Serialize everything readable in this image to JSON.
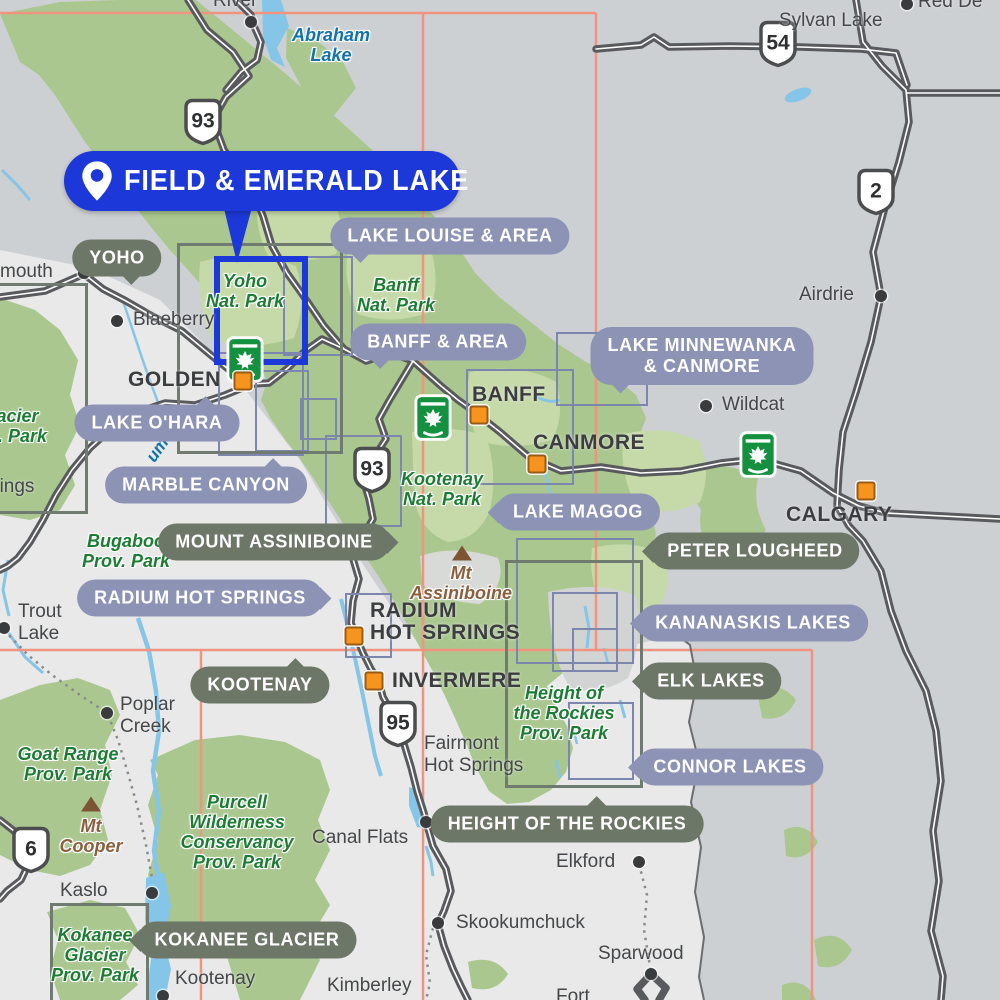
{
  "callout": {
    "label": "FIELD & EMERALD LAKE"
  },
  "region_pills": [
    {
      "label": "LAKE LOUISE & AREA",
      "x": 450,
      "y": 236,
      "style": "slate",
      "tail": "bl"
    },
    {
      "label": "BANFF & AREA",
      "x": 438,
      "y": 342,
      "style": "slate",
      "tail": "bl"
    },
    {
      "label": "LAKE MINNEWANKA & CANMORE",
      "lines": [
        "LAKE MINNEWANKA",
        "& CANMORE"
      ],
      "x": 702,
      "y": 356,
      "style": "slate",
      "tail": "bl"
    },
    {
      "label": "YOHO",
      "x": 117,
      "y": 258,
      "style": "olive",
      "tail": "br"
    },
    {
      "label": "LAKE O'HARA",
      "x": 157,
      "y": 423,
      "style": "slate",
      "tail": "tr"
    },
    {
      "label": "MARBLE CANYON",
      "x": 206,
      "y": 485,
      "style": "slate",
      "tail": "tr"
    },
    {
      "label": "MOUNT ASSINIBOINE",
      "x": 274,
      "y": 542,
      "style": "olive",
      "tail": "r"
    },
    {
      "label": "RADIUM HOT SPRINGS",
      "x": 200,
      "y": 598,
      "style": "slate",
      "tail": "r"
    },
    {
      "label": "LAKE MAGOG",
      "x": 578,
      "y": 512,
      "style": "slate",
      "tail": "l"
    },
    {
      "label": "PETER LOUGHEED",
      "x": 755,
      "y": 551,
      "style": "olive",
      "tail": "l"
    },
    {
      "label": "KANANASKIS LAKES",
      "x": 753,
      "y": 623,
      "style": "slate",
      "tail": "l"
    },
    {
      "label": "ELK LAKES",
      "x": 711,
      "y": 681,
      "style": "olive",
      "tail": "l"
    },
    {
      "label": "KOOTENAY",
      "x": 260,
      "y": 685,
      "style": "olive",
      "tail": "tr"
    },
    {
      "label": "CONNOR LAKES",
      "x": 730,
      "y": 767,
      "style": "slate",
      "tail": "l"
    },
    {
      "label": "HEIGHT OF THE ROCKIES",
      "x": 567,
      "y": 824,
      "style": "olive",
      "tail": "t"
    },
    {
      "label": "KOKANEE GLACIER",
      "x": 247,
      "y": 940,
      "style": "olive",
      "tail": "l"
    }
  ],
  "cities": [
    {
      "name": "GOLDEN",
      "lines": [
        "GOLDEN"
      ],
      "lx": 128,
      "ly": 369,
      "sx": 243,
      "sy": 381
    },
    {
      "name": "BANFF",
      "lines": [
        "BANFF"
      ],
      "lx": 472,
      "ly": 384,
      "sx": 479,
      "sy": 415
    },
    {
      "name": "CANMORE",
      "lines": [
        "CANMORE"
      ],
      "lx": 533,
      "ly": 432,
      "sx": 537,
      "sy": 464
    },
    {
      "name": "CALGARY",
      "lines": [
        "CALGARY"
      ],
      "lx": 786,
      "ly": 504,
      "sx": 866,
      "sy": 491
    },
    {
      "name": "RADIUM HOT SPRINGS",
      "lines": [
        "RADIUM",
        "HOT SPRINGS"
      ],
      "lx": 370,
      "ly": 600,
      "sx": 354,
      "sy": 636
    },
    {
      "name": "INVERMERE",
      "lines": [
        "INVERMERE"
      ],
      "lx": 392,
      "ly": 670,
      "sx": 374,
      "sy": 681
    }
  ],
  "towns": [
    {
      "name": "River",
      "lines": [
        "River"
      ],
      "lx": 213,
      "ly": -10,
      "dx": 251,
      "dy": 22
    },
    {
      "name": "Sylvan Lake",
      "lines": [
        "Sylvan Lake"
      ],
      "lx": 779,
      "ly": 10
    },
    {
      "name": "Red Deer",
      "lines": [
        "Red De"
      ],
      "lx": 918,
      "ly": -9,
      "dx": 907,
      "dy": 4
    },
    {
      "name": "mouth",
      "lines": [
        "mouth"
      ],
      "lx": 0,
      "ly": 261,
      "dx": 84,
      "dy": 273
    },
    {
      "name": "Blaeberry",
      "lines": [
        "Blaeberry"
      ],
      "lx": 133,
      "ly": 309,
      "dx": 117,
      "dy": 321
    },
    {
      "name": "Airdrie",
      "lines": [
        "Airdrie"
      ],
      "lx": 799,
      "ly": 284,
      "dx": 881,
      "dy": 296
    },
    {
      "name": "Wildcat",
      "lines": [
        "Wildcat"
      ],
      "lx": 722,
      "ly": 394,
      "dx": 706,
      "dy": 406
    },
    {
      "name": "Trout Lake",
      "lines": [
        "Trout",
        "Lake"
      ],
      "lx": 18,
      "ly": 601,
      "dx": 4,
      "dy": 628
    },
    {
      "name": "Poplar Creek",
      "lines": [
        "Poplar",
        "Creek"
      ],
      "lx": 120,
      "ly": 694,
      "dx": 107,
      "dy": 713
    },
    {
      "name": "Springs",
      "lines": [
        "Springs"
      ],
      "lx": -30,
      "ly": 476
    },
    {
      "name": "Kaslo",
      "lines": [
        "Kaslo"
      ],
      "lx": 60,
      "ly": 880,
      "dx": 152,
      "dy": 893
    },
    {
      "name": "Canal Flats",
      "lines": [
        "Canal Flats"
      ],
      "lx": 312,
      "ly": 827,
      "dx": 426,
      "dy": 822
    },
    {
      "name": "Fairmont Hot Springs",
      "lines": [
        "Fairmont",
        "Hot Springs"
      ],
      "lx": 424,
      "ly": 733
    },
    {
      "name": "Skookumchuck",
      "lines": [
        "Skookumchuck"
      ],
      "lx": 456,
      "ly": 912,
      "dx": 438,
      "dy": 923
    },
    {
      "name": "Elkford",
      "lines": [
        "Elkford"
      ],
      "lx": 556,
      "ly": 851,
      "dx": 639,
      "dy": 862
    },
    {
      "name": "Sparwood",
      "lines": [
        "Sparwood"
      ],
      "lx": 598,
      "ly": 943,
      "dx": 651,
      "dy": 974
    },
    {
      "name": "Kimberley",
      "lines": [
        "Kimberley"
      ],
      "lx": 327,
      "ly": 975
    },
    {
      "name": "Kootenay",
      "lines": [
        "Kootenay"
      ],
      "lx": 175,
      "ly": 968,
      "dx": 163,
      "dy": 996
    },
    {
      "name": "Fort",
      "lines": [
        "Fort"
      ],
      "lx": 556,
      "ly": 986
    }
  ],
  "park_labels": [
    {
      "name": "Abraham Lake",
      "lines": [
        "Abraham",
        "Lake"
      ],
      "x": 331,
      "y": 45,
      "color": "blue"
    },
    {
      "name": "Yoho Nat. Park",
      "lines": [
        "Yoho",
        "Nat. Park"
      ],
      "x": 245,
      "y": 291,
      "color": "green"
    },
    {
      "name": "Banff Nat. Park",
      "lines": [
        "Banff",
        "Nat. Park"
      ],
      "x": 396,
      "y": 295,
      "color": "green"
    },
    {
      "name": "Kootenay Nat. Park",
      "lines": [
        "Kootenay",
        "Nat. Park"
      ],
      "x": 442,
      "y": 489,
      "color": "green"
    },
    {
      "name": "Glacier Nat. Park",
      "lines": [
        "Glacier",
        "Nat. Park"
      ],
      "x": 8,
      "y": 426,
      "color": "green"
    },
    {
      "name": "Bugaboo Prov. Park",
      "lines": [
        "Bugaboo",
        "Prov. Park"
      ],
      "x": 126,
      "y": 551,
      "color": "green"
    },
    {
      "name": "Goat Range Prov. Park",
      "lines": [
        "Goat Range",
        "Prov. Park"
      ],
      "x": 68,
      "y": 764,
      "color": "green"
    },
    {
      "name": "Purcell Wilderness Conservancy Prov. Park",
      "lines": [
        "Purcell",
        "Wilderness",
        "Conservancy",
        "Prov. Park"
      ],
      "x": 237,
      "y": 832,
      "color": "green"
    },
    {
      "name": "Height of the Rockies Prov. Park",
      "lines": [
        "Height of",
        "the Rockies",
        "Prov. Park"
      ],
      "x": 564,
      "y": 713,
      "color": "green"
    },
    {
      "name": "Kokanee Glacier Prov. Park",
      "lines": [
        "Kokanee",
        "Glacier",
        "Prov. Park"
      ],
      "x": 95,
      "y": 955,
      "color": "green"
    }
  ],
  "mountains": [
    {
      "name": "Mt Assiniboine",
      "lines": [
        "Mt",
        "Assiniboine"
      ],
      "x": 461,
      "y": 583,
      "tx": 462,
      "ty": 553
    },
    {
      "name": "Mt Cooper",
      "lines": [
        "Mt",
        "Cooper"
      ],
      "x": 91,
      "y": 836,
      "tx": 91,
      "ty": 804
    }
  ],
  "river_fragment": {
    "text": "um",
    "x": 145,
    "y": 440,
    "rotate": -55
  },
  "highway_shields": [
    {
      "number": "93",
      "x": 203,
      "y": 124
    },
    {
      "number": "54",
      "x": 778,
      "y": 46
    },
    {
      "number": "2",
      "x": 876,
      "y": 194
    },
    {
      "number": "93",
      "x": 372,
      "y": 472
    },
    {
      "number": "95",
      "x": 398,
      "y": 726
    },
    {
      "number": "6",
      "x": 31,
      "y": 852
    }
  ],
  "park_gate_icons": [
    {
      "x": 245,
      "y": 362
    },
    {
      "x": 433,
      "y": 420
    },
    {
      "x": 758,
      "y": 457
    }
  ],
  "region_rects": [
    {
      "x": 283,
      "y": 256,
      "w": 66,
      "h": 96,
      "style": "slate"
    },
    {
      "x": 218,
      "y": 352,
      "w": 82,
      "h": 100,
      "style": "slate"
    },
    {
      "x": 255,
      "y": 370,
      "w": 50,
      "h": 78,
      "style": "slate"
    },
    {
      "x": 325,
      "y": 435,
      "w": 73,
      "h": 88,
      "style": "slate"
    },
    {
      "x": 466,
      "y": 369,
      "w": 104,
      "h": 112,
      "style": "slate"
    },
    {
      "x": 516,
      "y": 538,
      "w": 114,
      "h": 122,
      "style": "slate"
    },
    {
      "x": 552,
      "y": 592,
      "w": 62,
      "h": 76,
      "style": "slate"
    },
    {
      "x": 572,
      "y": 628,
      "w": 42,
      "h": 40,
      "style": "slate"
    },
    {
      "x": 568,
      "y": 702,
      "w": 62,
      "h": 74,
      "style": "slate"
    },
    {
      "x": 345,
      "y": 593,
      "w": 43,
      "h": 61,
      "style": "slate"
    },
    {
      "x": 300,
      "y": 398,
      "w": 33,
      "h": 38,
      "style": "slate"
    },
    {
      "x": 556,
      "y": 332,
      "w": 88,
      "h": 70,
      "style": "slate"
    },
    {
      "x": 177,
      "y": 243,
      "w": 160,
      "h": 205,
      "style": "olive"
    },
    {
      "x": -40,
      "y": 283,
      "w": 122,
      "h": 225,
      "style": "olive"
    },
    {
      "x": 505,
      "y": 560,
      "w": 132,
      "h": 222,
      "style": "olive"
    },
    {
      "x": 50,
      "y": 903,
      "w": 93,
      "h": 110,
      "style": "olive"
    }
  ],
  "selection_rect": {
    "x": 214,
    "y": 256,
    "w": 82,
    "h": 97
  },
  "colors": {
    "callout_blue": "#1d38d8",
    "pill_slate": "#8c93b4",
    "pill_olive": "#6d7767",
    "park_green": "#a9c78e",
    "park_green_light": "#c6daa9",
    "water_blue": "#85c6e8",
    "bg_east": "#cdd0d3",
    "bg_west": "#e8e9e8",
    "road_gray": "#595a5d",
    "grid_salmon": "#f0937f",
    "city_orange": "#f7941e",
    "label_green": "#1d7c34",
    "label_blue": "#1272aa",
    "label_brown": "#8a5f3e"
  }
}
